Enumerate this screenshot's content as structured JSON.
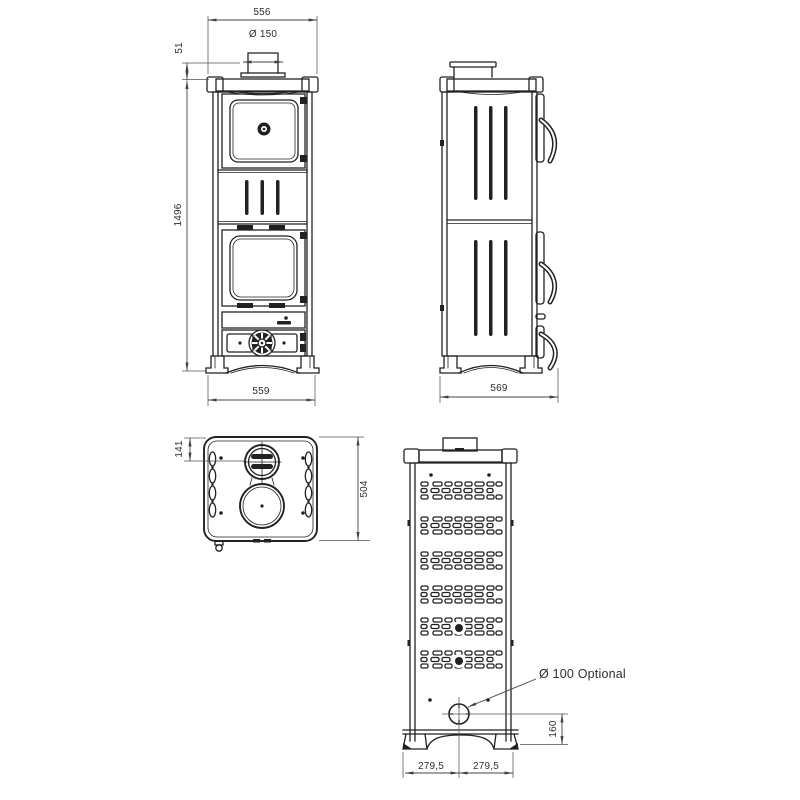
{
  "labels": {
    "front": {
      "width_top": "556",
      "flue_diameter": "Ø 150",
      "flue_height": "51",
      "height": "1496",
      "width_bottom": "559"
    },
    "side": {
      "depth": "569"
    },
    "top": {
      "flue_center_offset": "141",
      "depth": "504"
    },
    "back": {
      "optional_flue": "Ø 100 Optional",
      "flue_center_height": "160",
      "half_width_left": "279,5",
      "half_width_right": "279,5"
    }
  },
  "colors": {
    "line": "#222222",
    "dimension": "#444444",
    "background": "#ffffff"
  }
}
